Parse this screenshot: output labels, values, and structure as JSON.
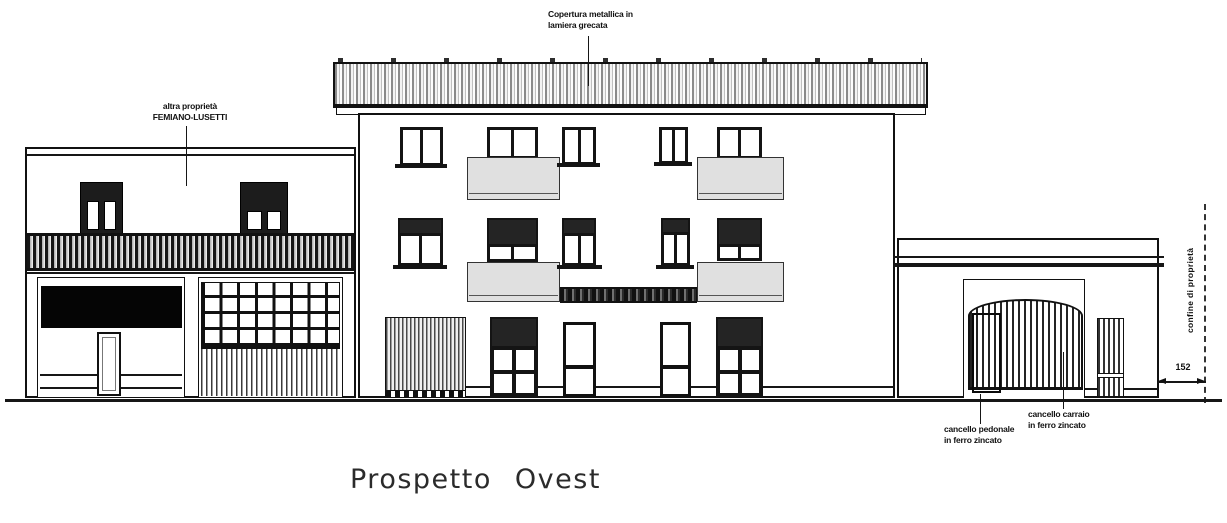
{
  "drawing_title": "Prospetto Ovest",
  "annotations": {
    "roof_note_line1": "Copertura metallica in",
    "roof_note_line2": "lamiera grecata",
    "neighbor_note_line1": "altra proprietà",
    "neighbor_note_line2": "FEMIANO-LUSETTI",
    "pedestrian_gate_note_line1": "cancello pedonale",
    "pedestrian_gate_note_line2": "in ferro zincato",
    "driveway_gate_note_line1": "cancello carraio",
    "driveway_gate_note_line2": "in ferro zincato",
    "boundary_note": "confine di proprietà",
    "dimension_value": "152"
  },
  "colors": {
    "line": "#111111",
    "balcony_parapet_fill": "#e0e0e0",
    "shutter_fill": "#1c1c1c",
    "background": "#ffffff"
  }
}
